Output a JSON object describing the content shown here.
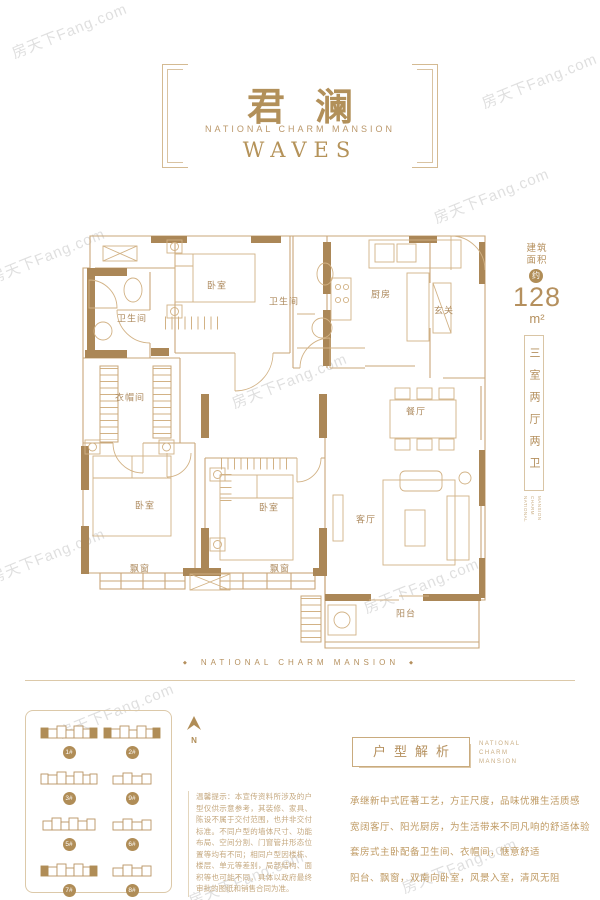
{
  "brand": {
    "watermark": "房天下Fang.com"
  },
  "header": {
    "title": "君澜",
    "subtitle": "NATIONAL CHARM MANSION",
    "tagline": "WAVES"
  },
  "floorplan": {
    "rooms": [
      "卫生间",
      "卧室",
      "卫生间",
      "厨房",
      "玄关",
      "衣帽间",
      "餐厅",
      "卧室",
      "卧室",
      "客厅",
      "飘窗",
      "飘窗",
      "阳台"
    ]
  },
  "area": {
    "label_1": "建筑",
    "label_2": "面积",
    "approx": "约",
    "value": "128",
    "unit": "m²",
    "layout": "三室两厅两卫",
    "brand_words": [
      "NATIONAL",
      "CHARM",
      "MANSION"
    ]
  },
  "divider": {
    "text": "NATIONAL CHARM MANSION",
    "diamond": "◆"
  },
  "siteplan": {
    "north": "N",
    "buildings": [
      {
        "label": "1#"
      },
      {
        "label": "2#"
      },
      {
        "label": "3#"
      },
      {
        "label": "9#"
      },
      {
        "label": "5#"
      },
      {
        "label": "6#"
      },
      {
        "label": "7#"
      },
      {
        "label": "8#"
      }
    ]
  },
  "disclaimer": {
    "text": "温馨提示：本宣传资料所涉及的户型仅供示意参考，其装修、家具、陈设不属于交付范围，也并非交付标准。不同户型的墙体尺寸、功能布局、空间分割、门窗管井形态位置等均有不同；相同户型因楼栋、楼层、单元等差别，局部结构、面积等也可能不同，具体以政府最终审批的图纸和销售合同为准。"
  },
  "analysis": {
    "title": "户型解析",
    "brand_words": [
      "NATIONAL",
      "CHARM",
      "MANSION"
    ],
    "lines": [
      "承继新中式匠著工艺，方正尺度，品味优雅生活质感",
      "宽阔客厅、阳光厨房，为生活带来不同凡响的舒适体验",
      "套房式主卧配备卫生间、衣帽间，惬意舒适",
      "阳台、飘窗，双南向卧室，风景入室，清风无阻"
    ]
  }
}
